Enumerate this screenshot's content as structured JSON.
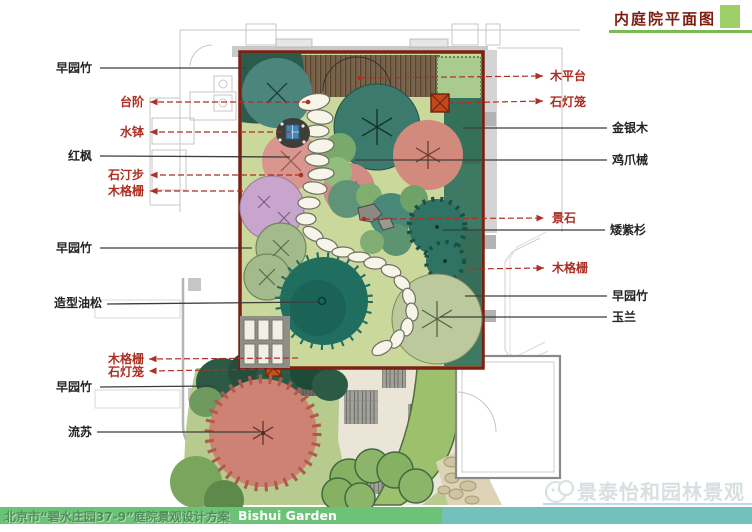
{
  "title": {
    "text": "内庭院平面图"
  },
  "footer": {
    "project": "北京市“碧水庄园37-9”庭院景观设计方案",
    "subtitle_en": "Bishui Garden"
  },
  "watermark": {
    "text": "景泰怡和园林景观"
  },
  "labels": {
    "left_black": [
      {
        "text": "早园竹"
      },
      {
        "text": "红枫"
      },
      {
        "text": "早园竹"
      },
      {
        "text": "造型油松"
      },
      {
        "text": "早园竹"
      },
      {
        "text": "流苏"
      }
    ],
    "left_red": [
      {
        "text": "台阶"
      },
      {
        "text": "水钵"
      },
      {
        "text": "石汀步"
      },
      {
        "text": "木格栅"
      },
      {
        "text": "木格栅"
      },
      {
        "text": "石灯笼"
      }
    ],
    "right_red": [
      {
        "text": "木平台"
      },
      {
        "text": "石灯笼"
      },
      {
        "text": "景石"
      },
      {
        "text": "木格栅"
      }
    ],
    "right_black": [
      {
        "text": "金银木"
      },
      {
        "text": "鸡爪械"
      },
      {
        "text": "矮紫杉"
      },
      {
        "text": "早园竹"
      },
      {
        "text": "玉兰"
      }
    ]
  },
  "colors": {
    "title_red": "#7d1d12",
    "accent_green": "#7cb854",
    "footer_green": "#6cc276",
    "footer_teal": "#74c1bb",
    "leader_red": "#ae2f24",
    "leader_black": "#3c3c3c",
    "courtyard_border": "#7a2014",
    "lawn": "#cbd89c"
  }
}
